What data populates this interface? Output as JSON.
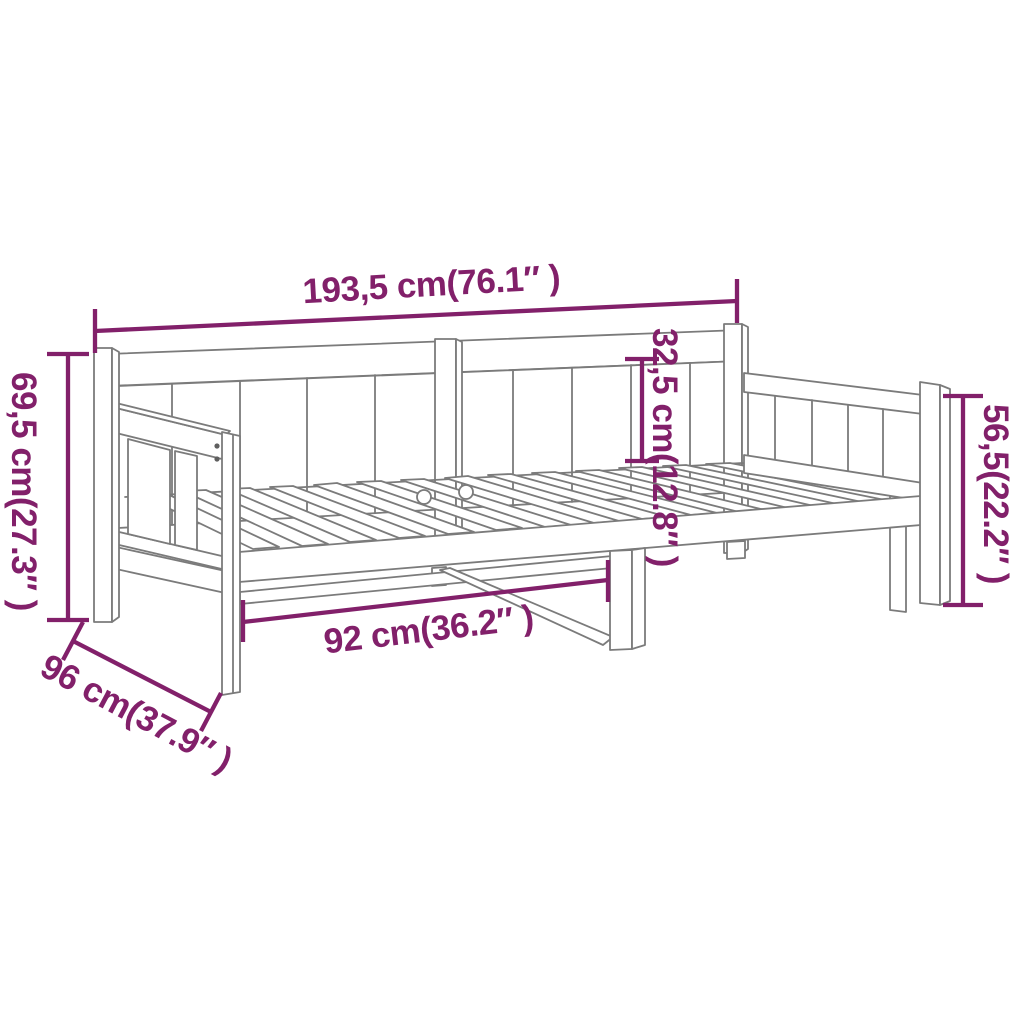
{
  "diagram": {
    "colors": {
      "dimension_accent": "#82206A",
      "line_art": "#7B7B7B",
      "background": "#FFFFFF"
    },
    "dimensions": {
      "total_width": "193,5 cm(76.1″ )",
      "height_left": "69,5 cm(27.3″ )",
      "backrest_height": "32,5 cm(12.8″ )",
      "height_right": "56,5(22.2″ )",
      "clearance_width": "92 cm(36.2″ )",
      "depth": "96 cm(37.9″ )"
    }
  }
}
